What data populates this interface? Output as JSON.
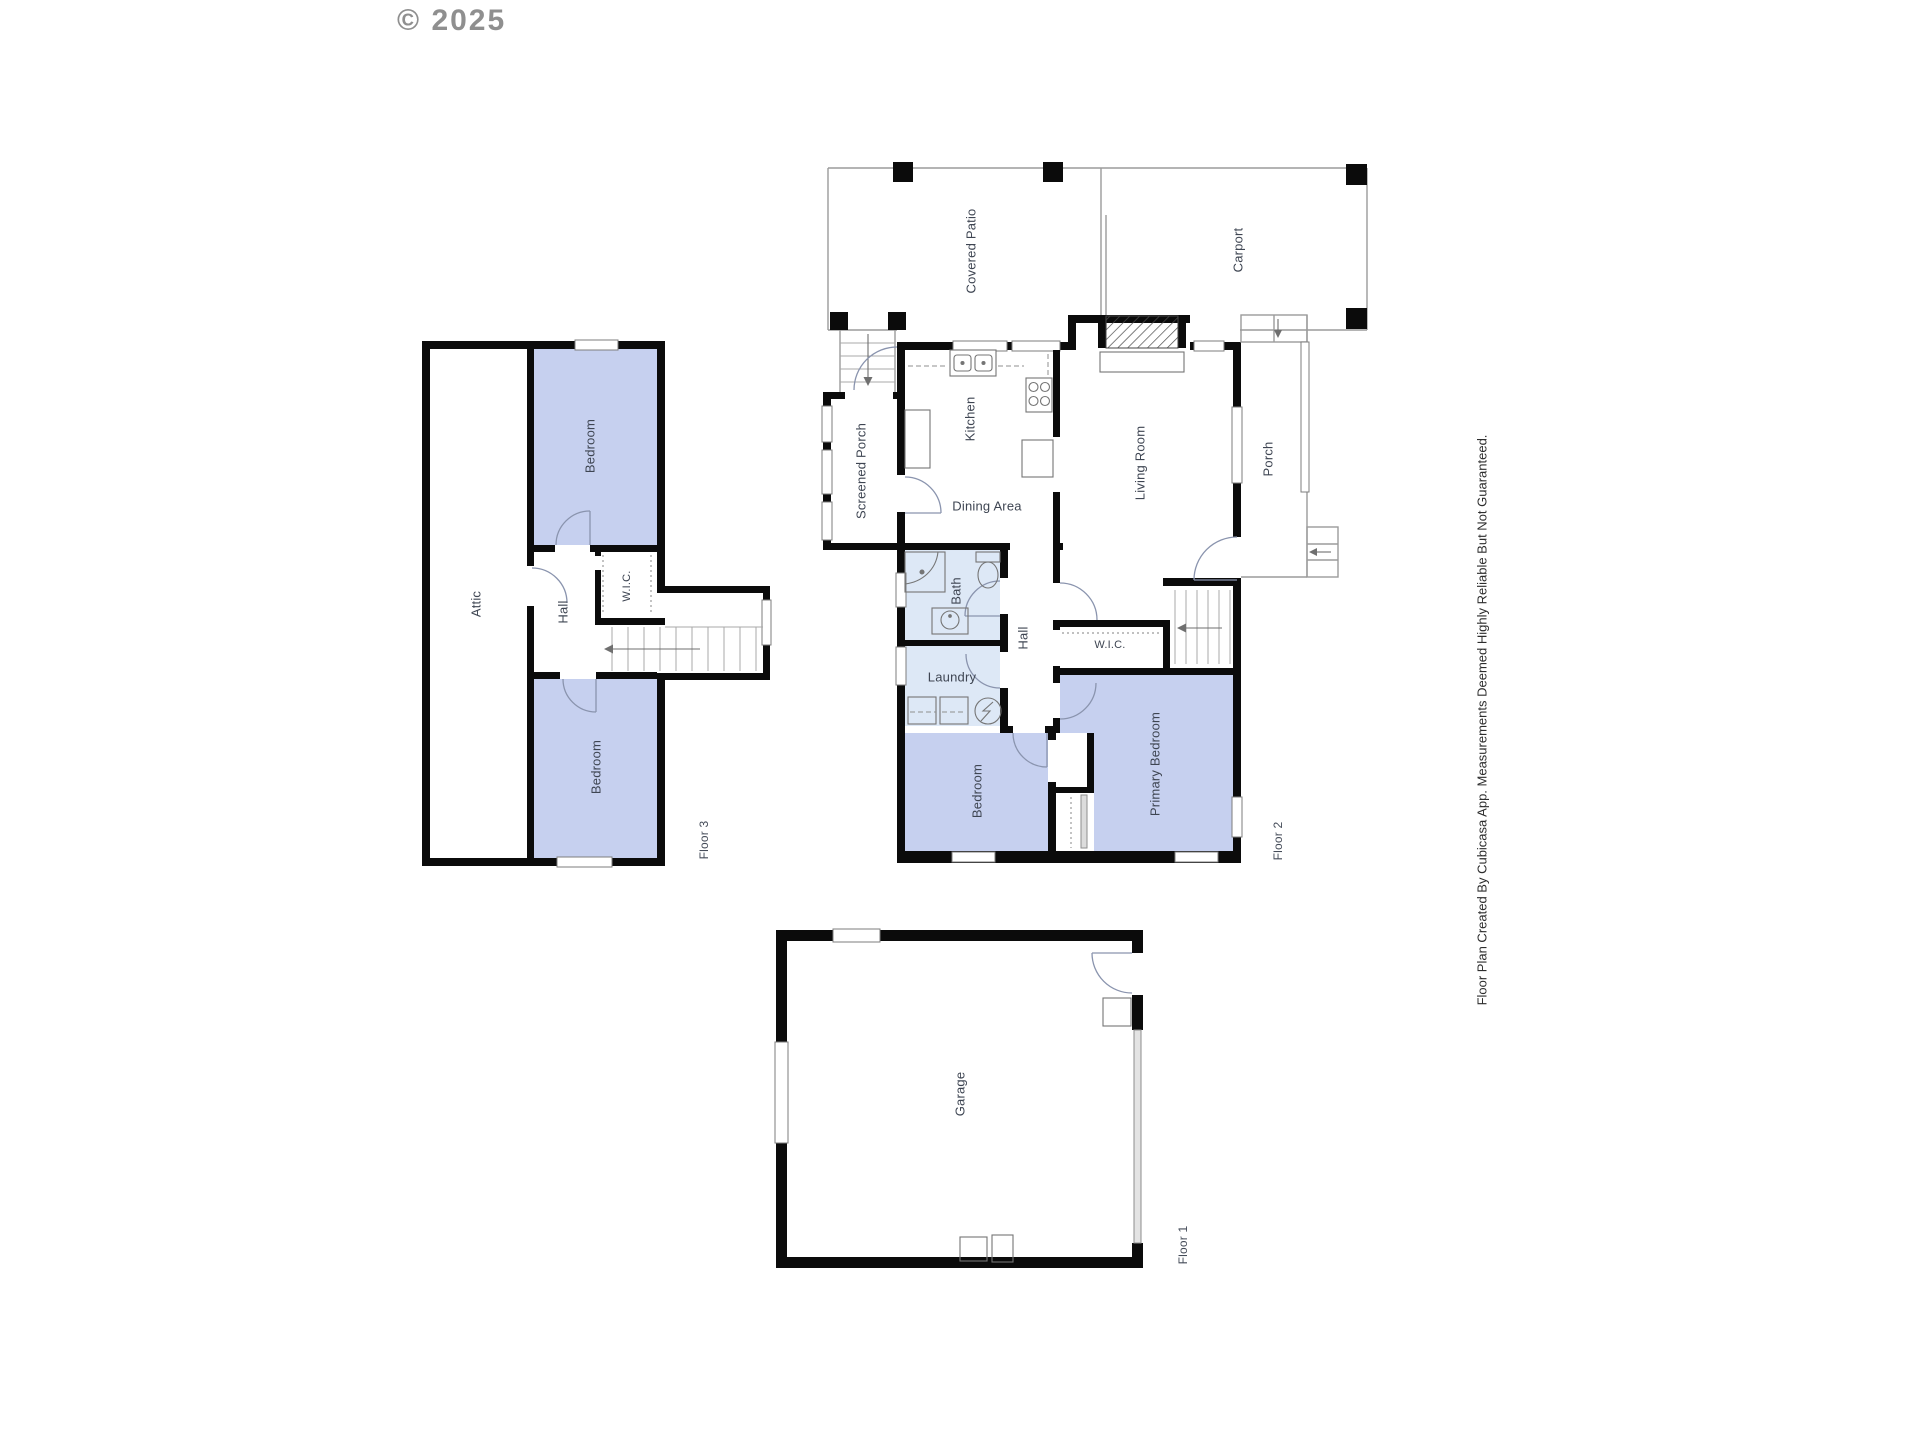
{
  "copyright": "© 2025",
  "disclaimer": "Floor Plan Created By Cubicasa App. Measurements Deemed Highly Reliable But Not Guaranteed.",
  "floor1": {
    "label": "Floor 1",
    "garage": "Garage"
  },
  "floor2": {
    "label": "Floor 2",
    "covered_patio": "Covered Patio",
    "carport": "Carport",
    "screened_porch": "Screened Porch",
    "kitchen": "Kitchen",
    "dining_area": "Dining Area",
    "living_room": "Living Room",
    "porch": "Porch",
    "bath": "Bath",
    "hall": "Hall",
    "laundry": "Laundry",
    "wic": "W.I.C.",
    "bedroom": "Bedroom",
    "primary_bedroom": "Primary Bedroom"
  },
  "floor3": {
    "label": "Floor 3",
    "attic": "Attic",
    "bedroom_upper": "Bedroom",
    "hall": "Hall",
    "wic": "W.I.C.",
    "bedroom_lower": "Bedroom"
  },
  "colors": {
    "room_fill": "#c6d0ef",
    "wet_room_fill": "#dde8f6",
    "wall": "#0b0b0b",
    "label_text": "#3e4552",
    "watermark": "#8f8f8f"
  }
}
